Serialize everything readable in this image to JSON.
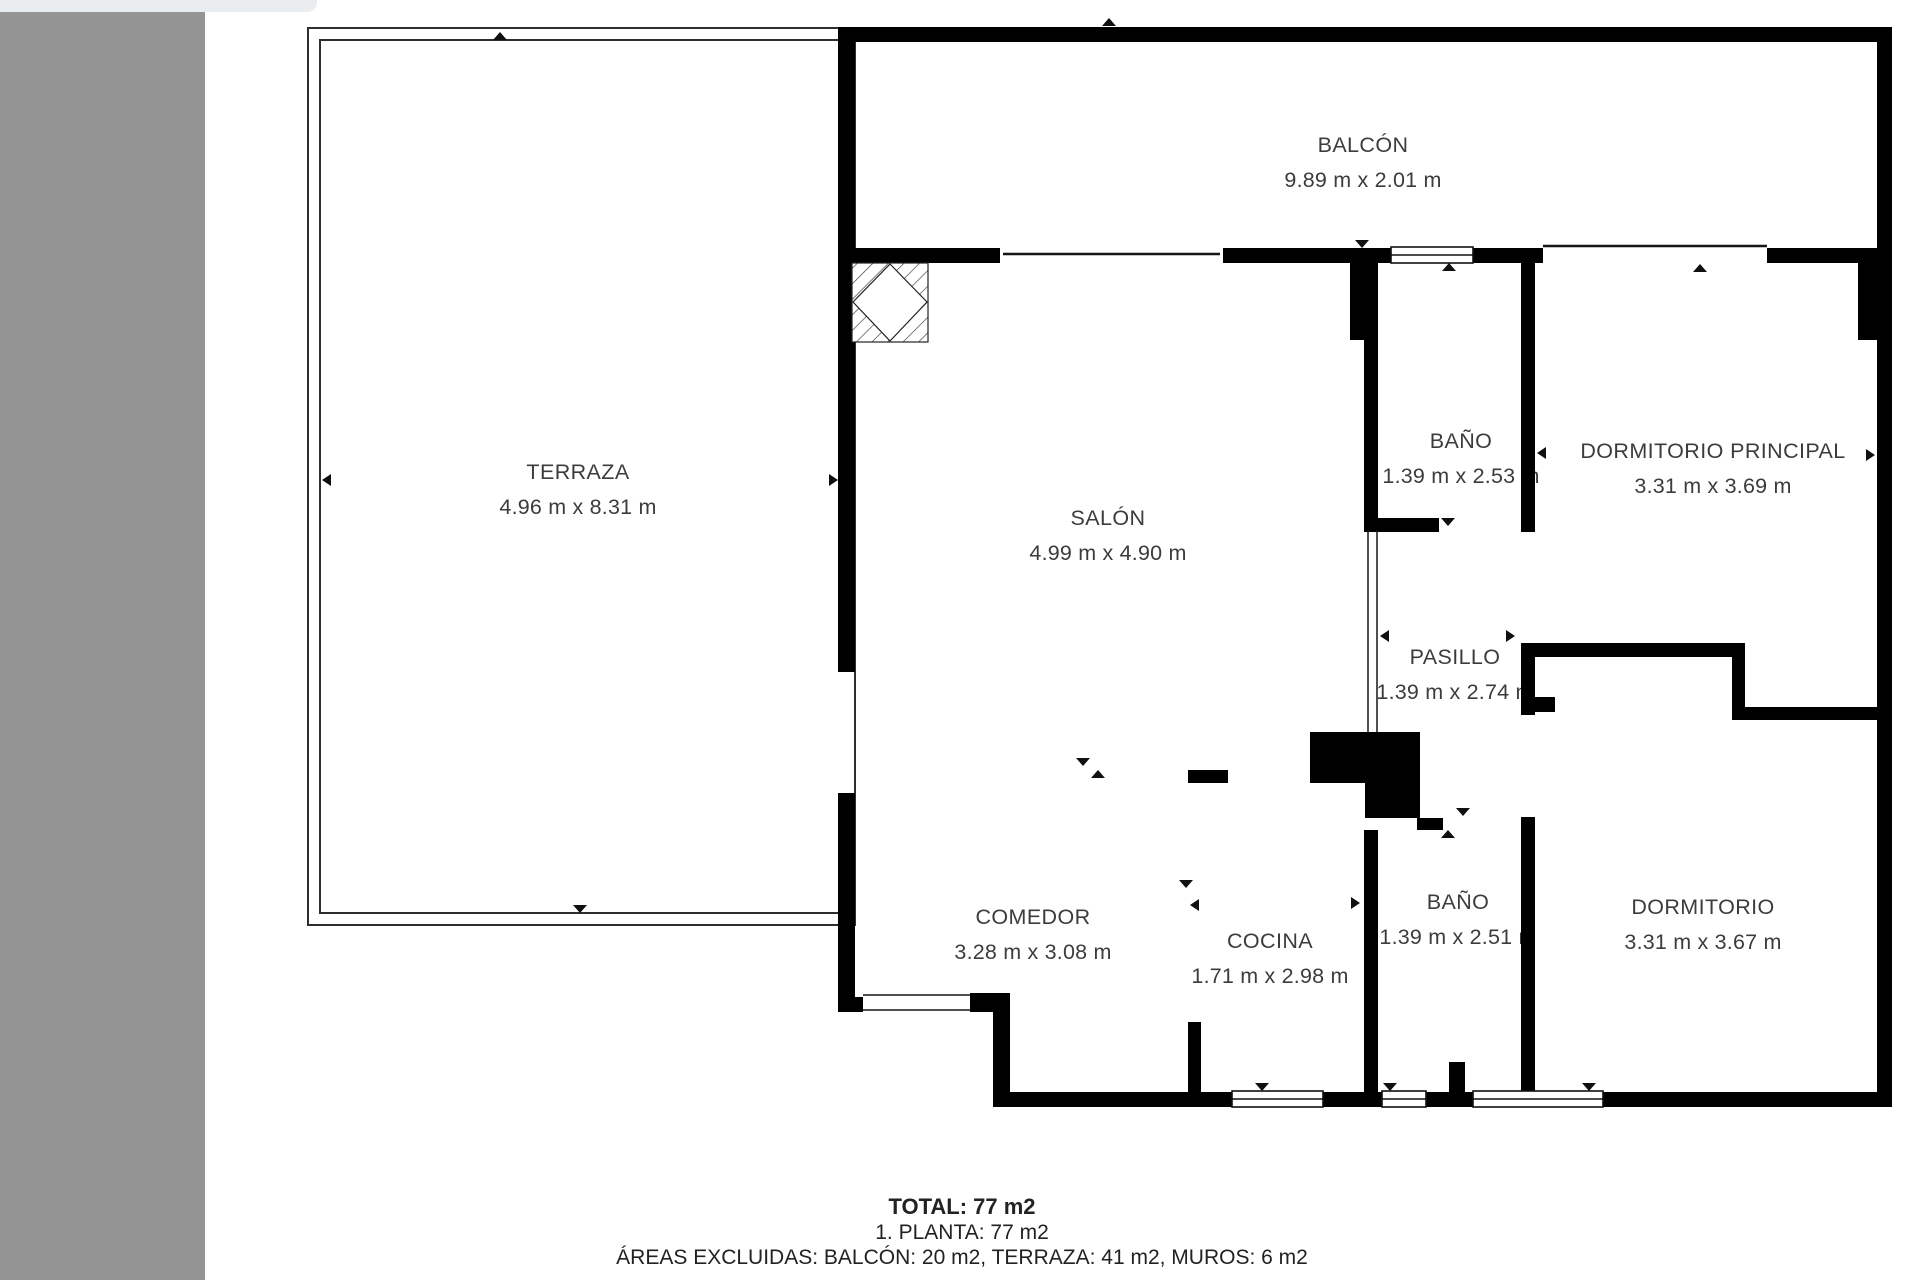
{
  "theme": {
    "wall": "#000000",
    "text": "#3c3c3c",
    "sidebar": "#949494",
    "tab": "#e9edf0",
    "background": "#ffffff"
  },
  "rooms": [
    {
      "name": "BALCÓN",
      "dims": "9.89 m x 2.01 m"
    },
    {
      "name": "TERRAZA",
      "dims": "4.96 m x 8.31 m"
    },
    {
      "name": "SALÓN",
      "dims": "4.99 m x 4.90 m"
    },
    {
      "name": "BAÑO",
      "dims": "1.39 m x 2.53 m"
    },
    {
      "name": "DORMITORIO PRINCIPAL",
      "dims": "3.31 m x 3.69 m"
    },
    {
      "name": "PASILLO",
      "dims": "1.39 m x 2.74 m"
    },
    {
      "name": "COMEDOR",
      "dims": "3.28 m x 3.08 m"
    },
    {
      "name": "COCINA",
      "dims": "1.71 m x 2.98 m"
    },
    {
      "name": "BAÑO",
      "dims": "1.39 m x 2.51 m"
    },
    {
      "name": "DORMITORIO",
      "dims": "3.31 m x 3.67 m"
    }
  ],
  "summary": {
    "total": "TOTAL: 77 m2",
    "planta": "1. PLANTA: 77 m2",
    "excluded": "ÁREAS EXCLUIDAS: BALCÓN: 20 m2, TERRAZA: 41 m2, MUROS: 6 m2"
  }
}
